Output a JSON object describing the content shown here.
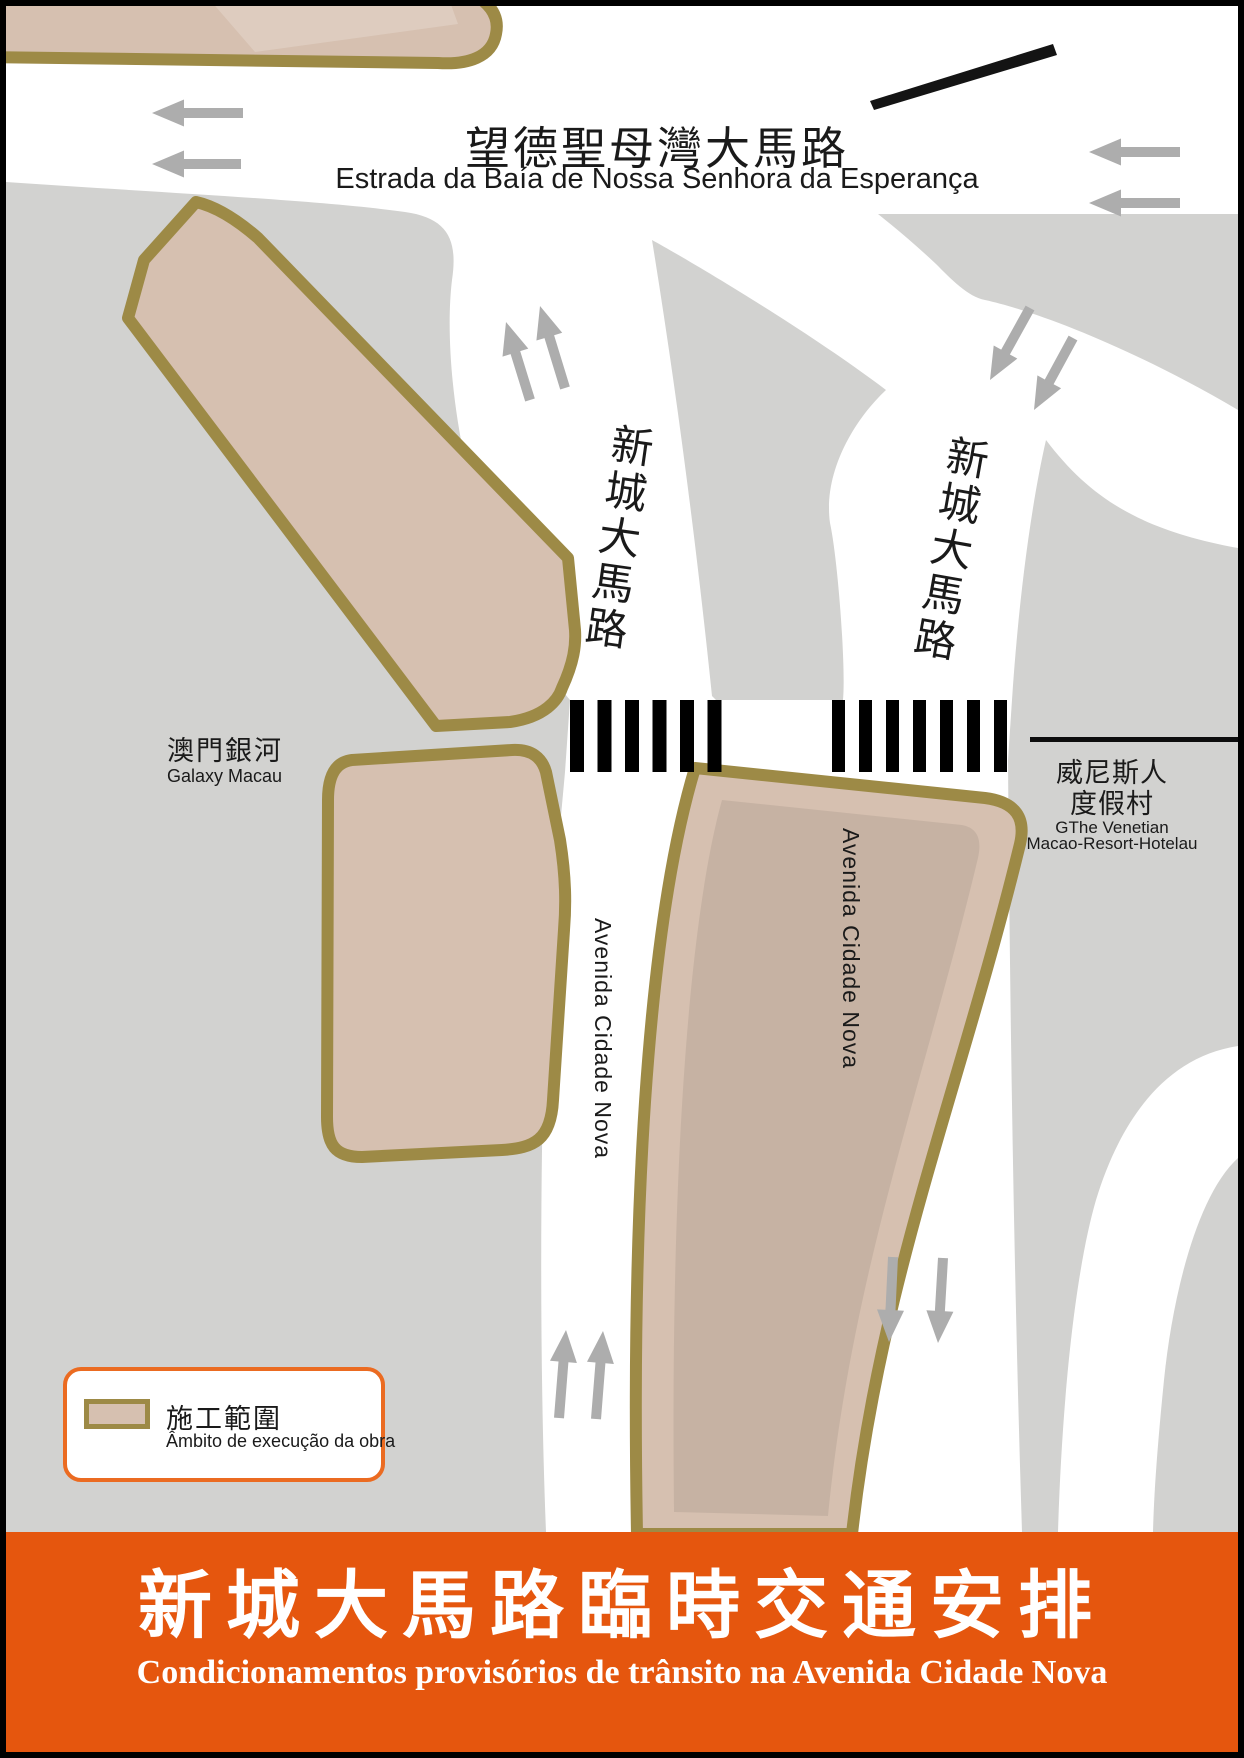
{
  "map": {
    "top_road": {
      "name_zh": "望德聖母灣大馬路",
      "name_pt": "Estrada da Baía de Nossa Senhora da Esperança"
    },
    "road_left_zh": "新城大馬路",
    "road_right_zh": "新城大馬路",
    "avenida_left": "Avenida Cidade Nova",
    "avenida_right": "Avenida Cidade Nova",
    "landmark_left": {
      "name_zh": "澳門銀河",
      "name_en": "Galaxy Macau"
    },
    "landmark_right": {
      "name_zh_line1": "威尼斯人",
      "name_zh_line2": "度假村",
      "name_en_line1": "GThe Venetian",
      "name_en_line2": "Macao-Resort-Hotelau"
    }
  },
  "legend": {
    "label_zh": "施工範圍",
    "label_pt": "Âmbito de execução da obra"
  },
  "banner": {
    "title_zh": "新城大馬路臨時交通安排",
    "title_pt": "Condicionamentos provisórios de trânsito na Avenida Cidade Nova"
  },
  "colors": {
    "road_gray": "#D2D2D0",
    "construction_fill": "#D6C0B0",
    "construction_border": "#9D8A46",
    "arrow_gray": "#ADADAD",
    "crosswalk_black": "#000000",
    "banner_orange": "#E5560E",
    "legend_border_orange": "#EB6B21",
    "text_dark": "#1A1A1A"
  }
}
